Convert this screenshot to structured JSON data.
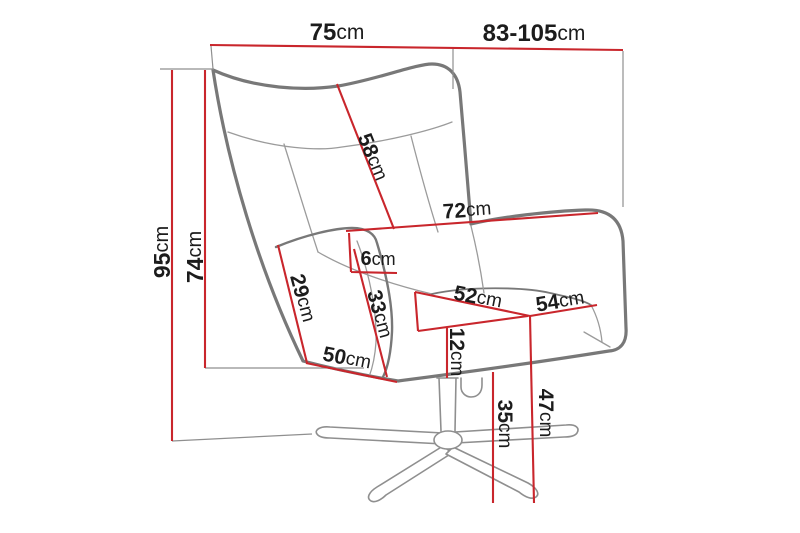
{
  "diagram": {
    "subject": "swivel-wingback-armchair-dimension-drawing",
    "unit": "cm",
    "colors": {
      "dimension_line": "#c9262c",
      "outline": "#787878",
      "seam": "#9b9b9b",
      "helper_line": "#8f8f8f",
      "label_text": "#1c1c1c",
      "background": "#ffffff"
    },
    "measurements": [
      {
        "name": "top-depth",
        "value": "75",
        "unit": "cm"
      },
      {
        "name": "overall-width-range",
        "value": "83-105",
        "unit": "cm"
      },
      {
        "name": "overall-height",
        "value": "95",
        "unit": "cm"
      },
      {
        "name": "backrest-height",
        "value": "74",
        "unit": "cm"
      },
      {
        "name": "backrest-length",
        "value": "58",
        "unit": "cm"
      },
      {
        "name": "backrest-width",
        "value": "72",
        "unit": "cm"
      },
      {
        "name": "armrest-outer-height",
        "value": "29",
        "unit": "cm"
      },
      {
        "name": "armrest-top-width",
        "value": "6",
        "unit": "cm"
      },
      {
        "name": "armrest-inner-height",
        "value": "33",
        "unit": "cm"
      },
      {
        "name": "seat-front-width",
        "value": "50",
        "unit": "cm"
      },
      {
        "name": "seat-width",
        "value": "52",
        "unit": "cm"
      },
      {
        "name": "seat-depth",
        "value": "54",
        "unit": "cm"
      },
      {
        "name": "seat-frame-height",
        "value": "12",
        "unit": "cm"
      },
      {
        "name": "underseat-clearance",
        "value": "35",
        "unit": "cm"
      },
      {
        "name": "seat-height",
        "value": "47",
        "unit": "cm"
      }
    ]
  }
}
